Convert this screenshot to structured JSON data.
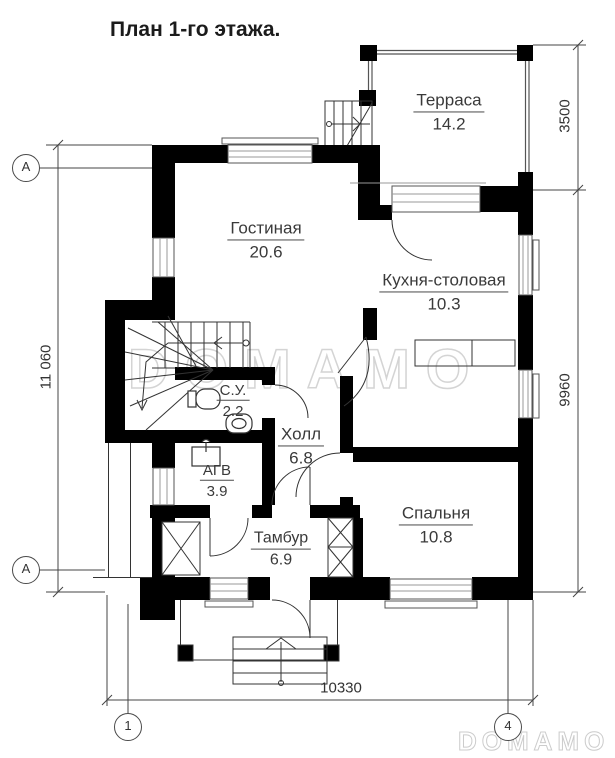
{
  "title": "План 1-го этажа.",
  "watermark": {
    "center": "DOMAMO",
    "corner": "DOMAMO"
  },
  "rooms": [
    {
      "name": "Терраса",
      "area": "14.2"
    },
    {
      "name": "Гостиная",
      "area": "20.6"
    },
    {
      "name": "Кухня-столовая",
      "area": "10.3"
    },
    {
      "name": "С.У.",
      "area": "2.2"
    },
    {
      "name": "Холл",
      "area": "6.8"
    },
    {
      "name": "АГВ",
      "area": "3.9"
    },
    {
      "name": "Тамбур",
      "area": "6.9"
    },
    {
      "name": "Спальня",
      "area": "10.8"
    }
  ],
  "dimensions": {
    "left_vertical": "11 060",
    "right_top": "3500",
    "right_middle": "9960",
    "bottom": "10330"
  },
  "axes": {
    "left_top": "А",
    "left_bottom": "А",
    "bottom_left": "1",
    "bottom_right": "4"
  },
  "icons": {
    "toilet": "toilet-plan-symbol",
    "sink": "sink-plan-symbol",
    "boiler": "boiler-plan-symbol",
    "stairs": "staircase-with-winders",
    "counter": "kitchen-counter"
  },
  "colors": {
    "walls": "#000000",
    "text": "#3a3a3a",
    "watermark": "#d4d4d4"
  }
}
